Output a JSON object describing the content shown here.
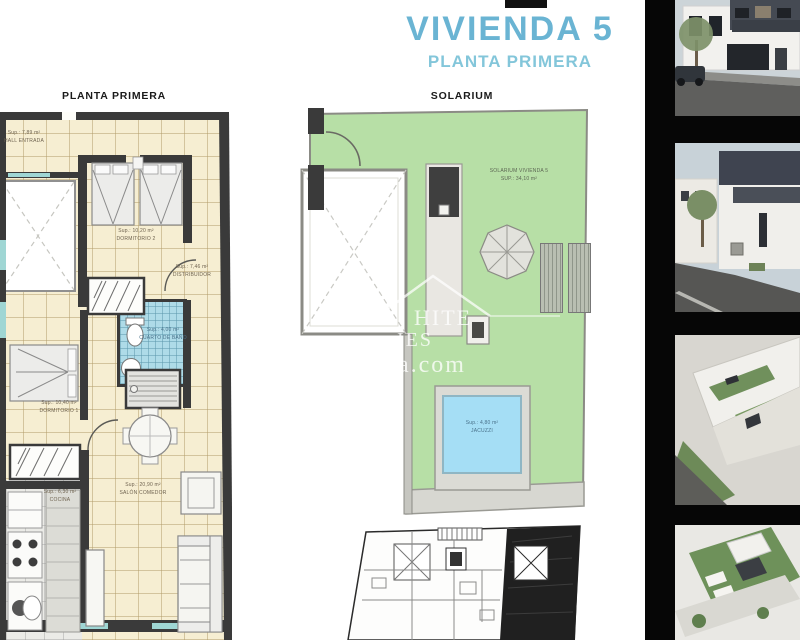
{
  "header": {
    "title": "VIVIENDA 5",
    "subtitle": "PLANTA PRIMERA"
  },
  "floor_plan": {
    "title": "PLANTA PRIMERA",
    "rooms": {
      "hall": {
        "sup": "Sup.: 7,89 m²",
        "name": "HALL ENTRADA"
      },
      "dormitorio2": {
        "sup": "Sup.: 10,20 m²",
        "name": "DORMITORIO 2"
      },
      "distribuidor": {
        "sup": "Sup.: 7,46 m²",
        "name": "DISTRIBUIDOR"
      },
      "bano": {
        "sup": "Sup.: 4,00 m²",
        "name": "CUARTO DE BAÑO"
      },
      "dormitorio1": {
        "sup": "Sup.: 10,40 m²",
        "name": "DORMITORIO 1"
      },
      "cocina": {
        "sup": "Sup.: 6,30 m²",
        "name": "COCINA"
      },
      "salon": {
        "sup": "Sup.: 20,90 m²",
        "name": "SALÓN COMEDOR"
      }
    }
  },
  "solarium": {
    "title": "SOLARIUM",
    "label": "SOLARIUM VIVIENDA 5",
    "sup": "SUP.: 34,10 m²",
    "pool": {
      "sup": "Sup.: 4,80 m²",
      "name": "JACUZZI"
    }
  },
  "watermark": {
    "line1": "HITE",
    "line2": "IES",
    "line3": "da.com"
  },
  "photos": {
    "items": [
      "street-render-front",
      "street-render-side",
      "aerial-render-terraces",
      "aerial-render-rooftop"
    ]
  },
  "colors": {
    "title_blue": "#6ab4d3",
    "subtitle_blue": "#83c6da",
    "plan_floor_cream": "#f6eed2",
    "wall_dark": "#3a3a3a",
    "bath_tile_blue": "#aedbe8",
    "solarium_green": "#b7dfa6",
    "pool_blue": "#a5def5",
    "photo_strip_black": "#060606"
  }
}
